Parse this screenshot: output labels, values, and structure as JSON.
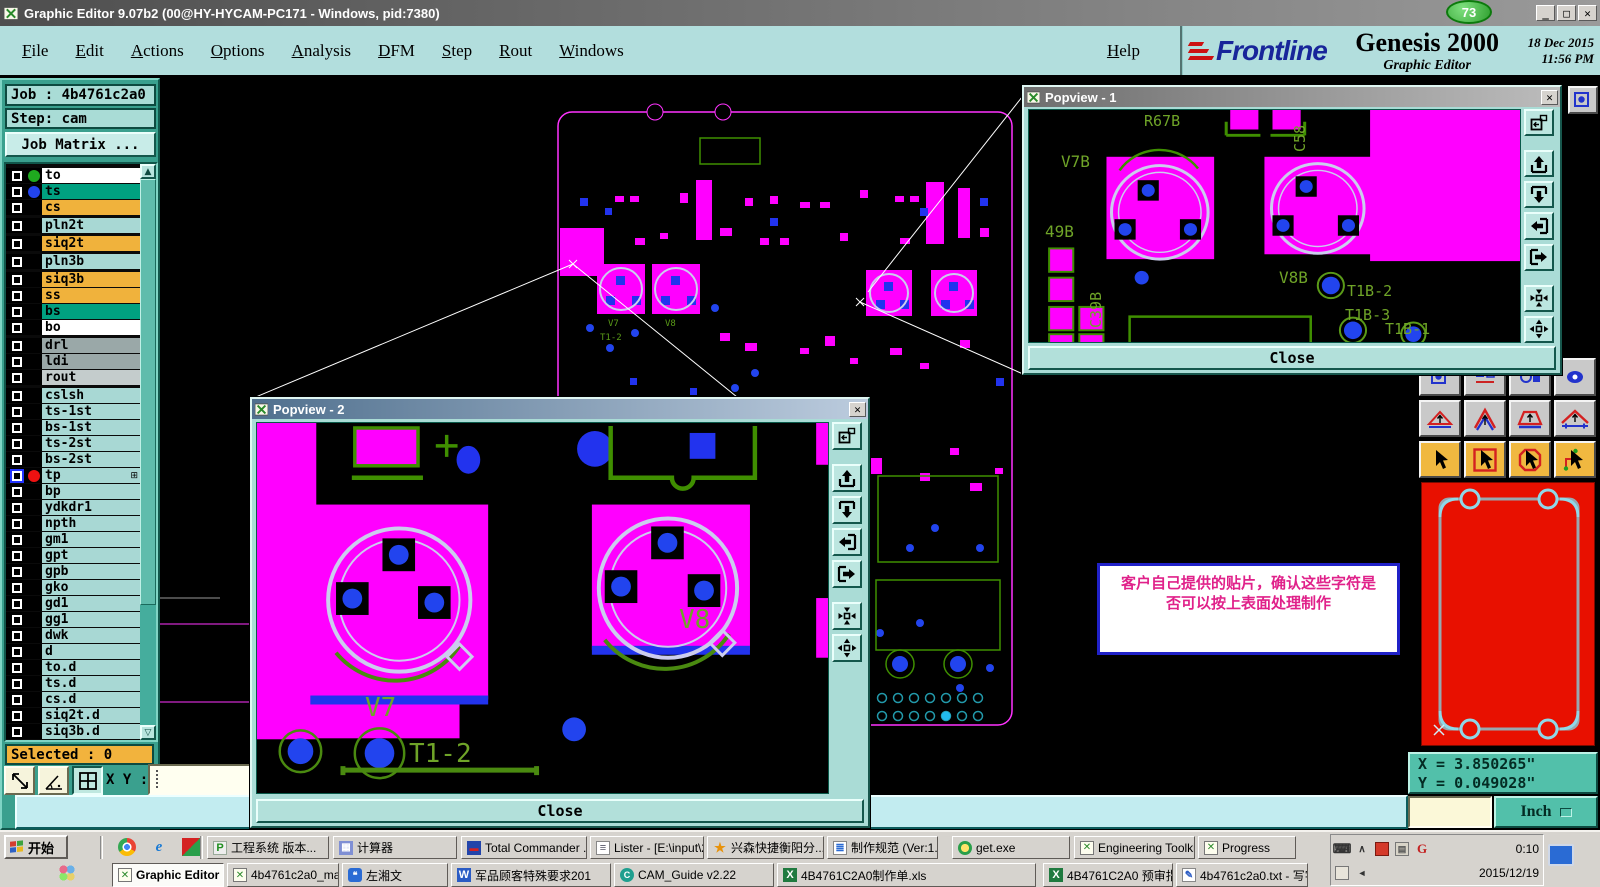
{
  "window": {
    "title": "Graphic Editor 9.07b2 (00@HY-HYCAM-PC171 - Windows, pid:7380)",
    "badge": "73"
  },
  "menu": {
    "items": [
      "File",
      "Edit",
      "Actions",
      "Options",
      "Analysis",
      "DFM",
      "Step",
      "Rout",
      "Windows"
    ],
    "help": "Help"
  },
  "brand": {
    "logo_text": "Frontline",
    "product": "Genesis 2000",
    "date": "18 Dec 2015",
    "time": "11:56 PM",
    "subtitle": "Graphic Editor"
  },
  "sidebar": {
    "job": "Job : 4b4761c2a0",
    "step": "Step: cam",
    "job_matrix": "Job Matrix ...",
    "selected": "Selected : 0",
    "xy_label": "X Y :",
    "layers": [
      {
        "name": "to",
        "bg": "#ffffff",
        "dot": "#1faa1f",
        "group_start": true
      },
      {
        "name": "ts",
        "bg": "#00a080",
        "dot": "#2244ee"
      },
      {
        "name": "cs",
        "bg": "#f0b23c"
      },
      {
        "name": "pln2t",
        "bg": "#a8d8d4",
        "group_start": true
      },
      {
        "name": "siq2t",
        "bg": "#f0b23c",
        "group_start": true
      },
      {
        "name": "pln3b",
        "bg": "#a8d8d4",
        "group_start": true
      },
      {
        "name": "siq3b",
        "bg": "#f0b23c",
        "group_start": true
      },
      {
        "name": "ss",
        "bg": "#f0b23c"
      },
      {
        "name": "bs",
        "bg": "#00a080"
      },
      {
        "name": "bo",
        "bg": "#ffffff"
      },
      {
        "name": "drl",
        "bg": "#9aa8a8",
        "group_start": true
      },
      {
        "name": "ldi",
        "bg": "#9aa8a8"
      },
      {
        "name": "rout",
        "bg": "#c4cccc"
      },
      {
        "name": "cslsh",
        "bg": "#a8d8d4",
        "group_start": true
      },
      {
        "name": "ts-1st",
        "bg": "#a8d8d4"
      },
      {
        "name": "bs-1st",
        "bg": "#a8d8d4"
      },
      {
        "name": "ts-2st",
        "bg": "#a8d8d4"
      },
      {
        "name": "bs-2st",
        "bg": "#a8d8d4"
      },
      {
        "name": "tp",
        "bg": "#a8d8d4",
        "dot": "#ee1111",
        "selected": true,
        "marker": "⊞"
      },
      {
        "name": "bp",
        "bg": "#a8d8d4"
      },
      {
        "name": "ydkdr1",
        "bg": "#a8d8d4"
      },
      {
        "name": "npth",
        "bg": "#a8d8d4"
      },
      {
        "name": "gm1",
        "bg": "#a8d8d4"
      },
      {
        "name": "gpt",
        "bg": "#a8d8d4"
      },
      {
        "name": "gpb",
        "bg": "#a8d8d4"
      },
      {
        "name": "gko",
        "bg": "#a8d8d4"
      },
      {
        "name": "gd1",
        "bg": "#a8d8d4"
      },
      {
        "name": "gg1",
        "bg": "#a8d8d4"
      },
      {
        "name": "dwk",
        "bg": "#a8d8d4"
      },
      {
        "name": "d",
        "bg": "#a8d8d4"
      },
      {
        "name": "to.d",
        "bg": "#a8d8d4"
      },
      {
        "name": "ts.d",
        "bg": "#a8d8d4"
      },
      {
        "name": "cs.d",
        "bg": "#a8d8d4"
      },
      {
        "name": "siq2t.d",
        "bg": "#a8d8d4"
      },
      {
        "name": "siq3b.d",
        "bg": "#a8d8d4"
      }
    ]
  },
  "popview1": {
    "title": "Popview - 1",
    "close": "Close",
    "labels": {
      "r67b": "R67B",
      "c58": "C58",
      "v7b": "V7B",
      "l49b": "49B",
      "c39b": "C39B",
      "v8b": "V8B",
      "t1b2": "T1B-2",
      "t1b3": "T1B-3",
      "t1b1": "T1B-1"
    }
  },
  "popview2": {
    "title": "Popview - 2",
    "close": "Close",
    "labels": {
      "v7": "V7",
      "v8": "V8",
      "t12": "T1-2"
    }
  },
  "annotation": {
    "line1": "客户自己提供的贴片，确认这些字符是",
    "line2": "否可以按上表面处理制作"
  },
  "coords": {
    "x": "X = 3.850265\"",
    "y": "Y = 0.049028\"",
    "units": "Inch"
  },
  "taskbar": {
    "start": "开始",
    "row1": [
      "工程系统 版本...",
      "计算器",
      "Total Commander ...",
      "Lister - [E:\\input\\2...",
      "兴森快捷衡阳分...",
      "制作规范 (Ver:1....",
      "get.exe",
      "Engineering Toolki...",
      "Progress"
    ],
    "row2": [
      "Graphic Editor 9.07b2",
      "4b4761c2a0_main_ga...",
      "左湘文",
      "军品顾客特殊要求201",
      "CAM_Guide v2.22",
      "4B4761C2A0制作单.xls",
      "4B4761C2A0 预审指示",
      "4b4761c2a0.txt - 写字板"
    ],
    "tray": {
      "time": "0:10",
      "date": "2015/12/19"
    }
  },
  "colors": {
    "pad_magenta": "#ff00ff",
    "hole_blue": "#2244ee",
    "silk_green": "#4a8a10",
    "swatch_red": "#e81000",
    "panel_teal": "#b2dedd"
  }
}
